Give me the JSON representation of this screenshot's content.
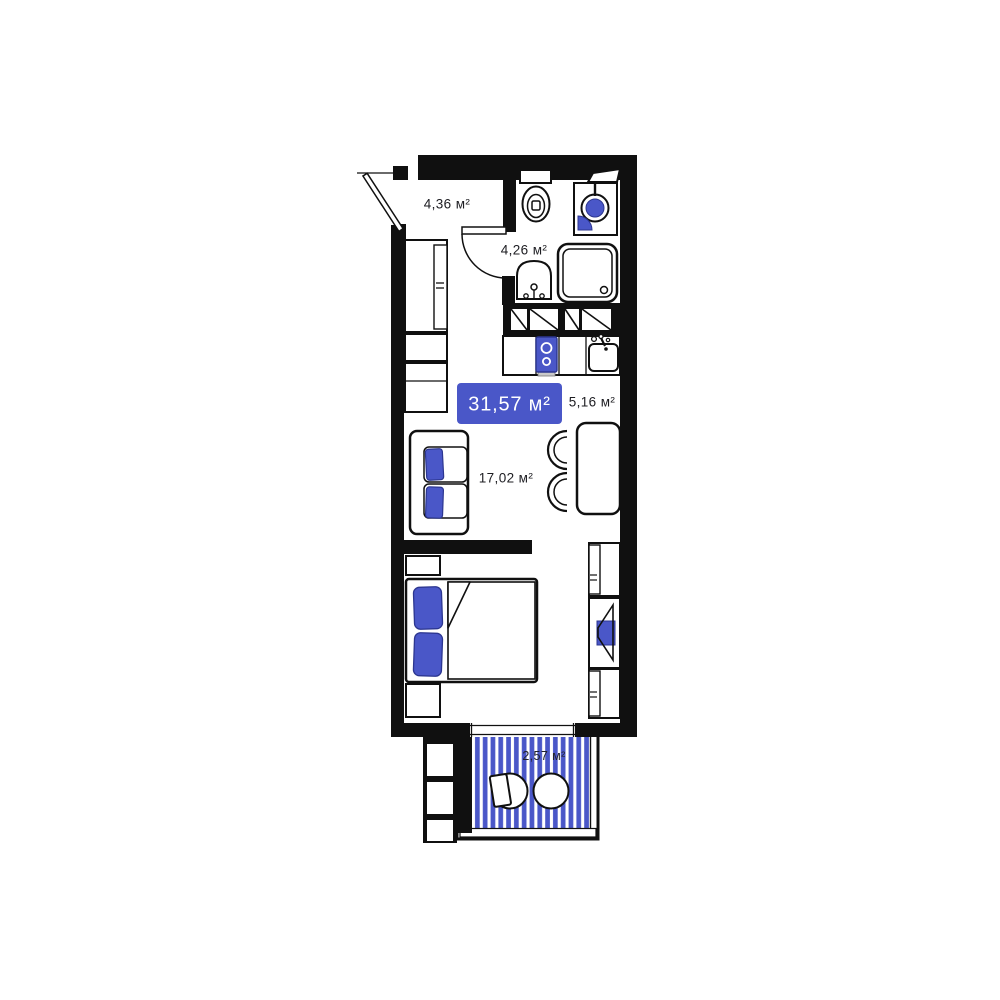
{
  "plan": {
    "badge": {
      "total_area": "31,57 м²"
    },
    "rooms": {
      "hallway": {
        "area": "4,36 м²"
      },
      "bathroom": {
        "area": "4,26 м²"
      },
      "kitchen": {
        "area": "5,16 м²"
      },
      "living": {
        "area": "17,02 м²"
      },
      "balcony": {
        "area": "2,57 м²"
      }
    },
    "colors": {
      "accent_blue": "#4a57c8",
      "wall_black": "#101010",
      "label_text": "#1d1d22",
      "badge_text": "#ffffff"
    },
    "icons": [
      "entrance-door-icon",
      "bathroom-door-icon",
      "toilet-icon",
      "washing-machine-icon",
      "bath-sink-icon",
      "shower-icon",
      "stove-icon",
      "kitchen-sink-icon",
      "wardrobe-icon",
      "sofa-icon",
      "dining-table-icon",
      "chair-icon",
      "bed-icon",
      "nightstand-icon",
      "tv-icon",
      "cabinet-icon",
      "balcony-chair-icon",
      "balcony-table-icon",
      "ladder-icon"
    ]
  }
}
